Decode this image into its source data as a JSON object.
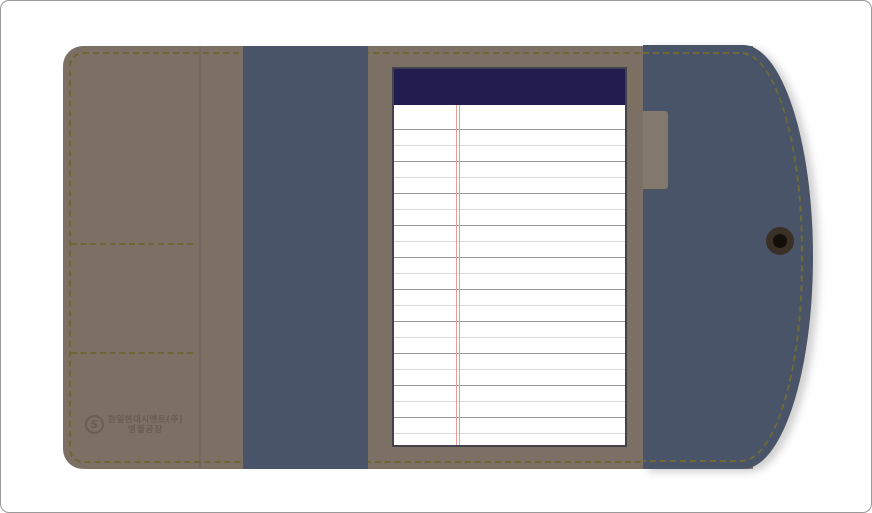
{
  "colors": {
    "canvas-bg": "#ffffff",
    "canvas-border": "#9a9a9a",
    "taupe": "#7c7064",
    "stitch": "#6c652f",
    "fold": "#6a6054",
    "blue": "#4a5468",
    "flap-stitch": "#75702f",
    "navy": "#221d4e",
    "paper": "#ffffff",
    "paper-border": "#42424e",
    "line-dark": "#989898",
    "line-light": "#d9d9d9",
    "redline": "#ea9d97",
    "tab": "#83786c",
    "snap-outer": "#3b3026",
    "snap-inner": "#140e09",
    "logo": "#685d52"
  },
  "logo": {
    "icon_letter": "S",
    "line1": "한일현대시멘트(주)",
    "line2": "영월공장"
  },
  "notepad": {
    "line_count": 20,
    "first_line_top": 24,
    "line_spacing": 16,
    "margin_line_left": 62,
    "margin_line_gap": 3
  }
}
